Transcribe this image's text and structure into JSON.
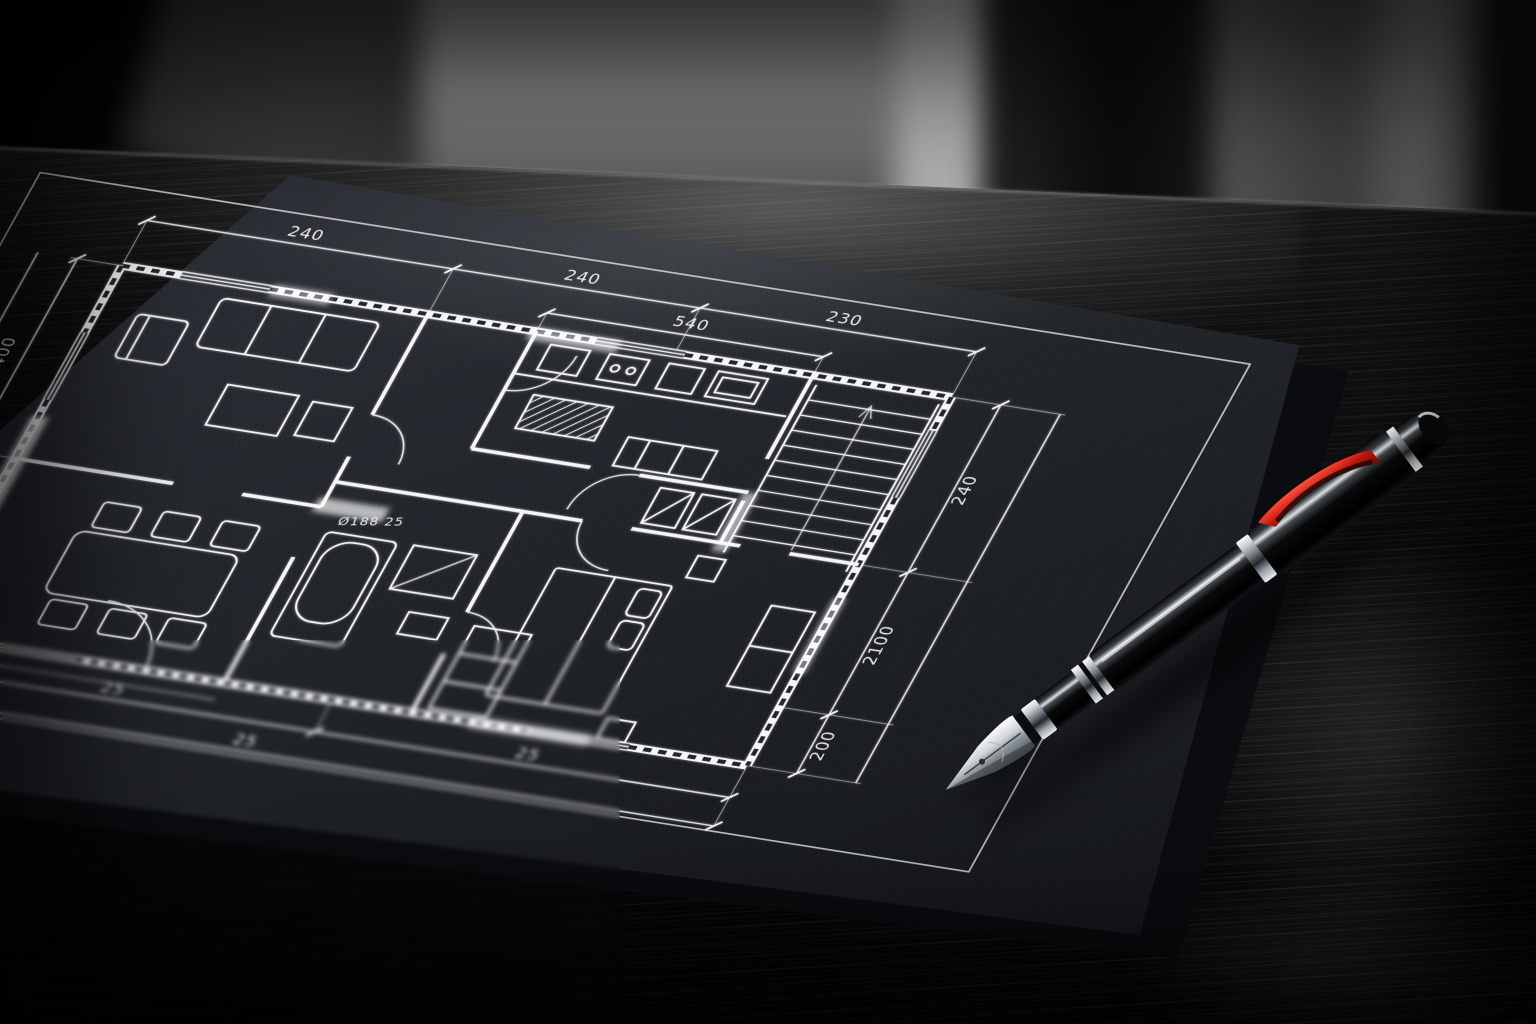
{
  "scene": {
    "type": "photograph",
    "description": "Black blueprint sheet with a white hand-drafted apartment floor plan lying on a dark wooden desk in front of a blurred interior; a black fountain pen with chrome trim and a red clip accent rests across the right edge of the sheet, nib pointing to the lower left.",
    "objects": [
      "blueprint paper",
      "second sheet underneath",
      "fountain pen",
      "wooden desk",
      "blurred room background"
    ],
    "background": {
      "style": "blurred interior",
      "colors": {
        "left": "#0a0a0a",
        "center_panel": "#8f8f8f",
        "bright_slit": "#bdbdbd",
        "pillar": "#0b0b0b",
        "right_panel": "#555555"
      }
    },
    "table": {
      "material": "dark wood",
      "base_color": "#0b0b0b",
      "grain_color": "#2a2a2a",
      "sheen_color": "#ffffff"
    },
    "paper": {
      "color": "#22262b",
      "margin_line_color": "#e9ecf0",
      "under_sheet_color": "#0b0c0f"
    },
    "plan": {
      "line_color": "#f3f5f8",
      "rooms": [
        "living room",
        "dining area",
        "kitchen",
        "hallway",
        "bathroom",
        "bedroom",
        "stairs"
      ],
      "dimensions": {
        "top": [
          "240",
          "240",
          "230"
        ],
        "top_inner": [
          "540"
        ],
        "right": [
          "240",
          "2100",
          "200"
        ],
        "left": [
          "400",
          "140"
        ],
        "bottom": [
          "25",
          "25",
          "25"
        ]
      },
      "annotations": [
        "Ø129 80",
        "Ø188 25"
      ]
    },
    "pen": {
      "type": "fountain pen",
      "body_color": "#0b0b0d",
      "trim_color": "#d9dee3",
      "accent_color": "#c01408",
      "nib_color": "#eef1f4"
    }
  }
}
